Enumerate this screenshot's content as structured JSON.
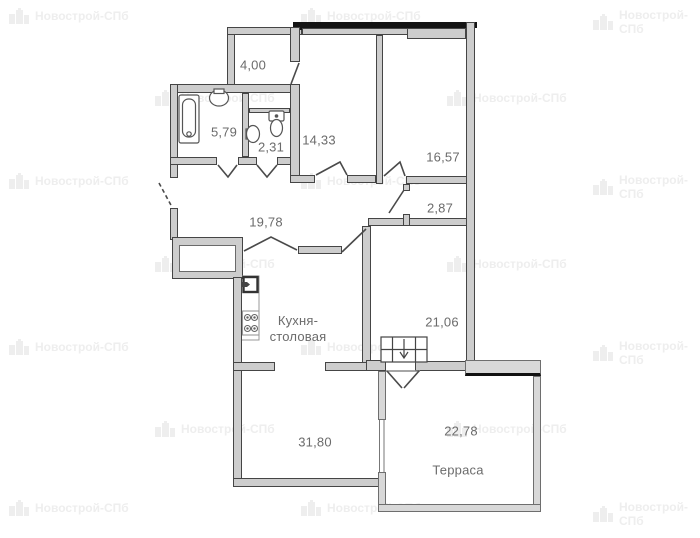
{
  "document": {
    "kind": "apartment floor plan"
  },
  "watermark": {
    "text": "Новострой-СПб",
    "positions": [
      [
        8,
        8
      ],
      [
        300,
        8
      ],
      [
        592,
        8
      ],
      [
        154,
        90
      ],
      [
        446,
        90
      ],
      [
        8,
        173
      ],
      [
        300,
        173
      ],
      [
        592,
        173
      ],
      [
        154,
        256
      ],
      [
        446,
        256
      ],
      [
        8,
        339
      ],
      [
        300,
        339
      ],
      [
        592,
        339
      ],
      [
        154,
        421
      ],
      [
        446,
        421
      ],
      [
        8,
        500
      ],
      [
        300,
        500
      ],
      [
        592,
        500
      ]
    ]
  },
  "rooms": {
    "balcony": {
      "area": "4,00"
    },
    "bathroom": {
      "area": "5,79"
    },
    "wc": {
      "area": "2,31"
    },
    "bedroom1": {
      "area": "14,33"
    },
    "bedroom2": {
      "area": "16,57"
    },
    "hallway": {
      "area": "19,78"
    },
    "storage": {
      "area": "2,87"
    },
    "living": {
      "area": "21,06"
    },
    "kitchen": {
      "area": "31,80",
      "name_line1": "Кухня-",
      "name_line2": "столовая"
    },
    "terrace": {
      "area": "22,78",
      "name": "Терраса"
    }
  },
  "colors": {
    "wall_fill": "#cdcdcd",
    "wall_edge": "#454545",
    "terrace_wall_fill": "#d8d8d8",
    "terrace_wall_edge": "#6e6e6e",
    "glazing_band": "#141414",
    "label_color": "#6b6b6b",
    "fixture_stroke": "#555555",
    "watermark_color": "#eeeeee"
  }
}
